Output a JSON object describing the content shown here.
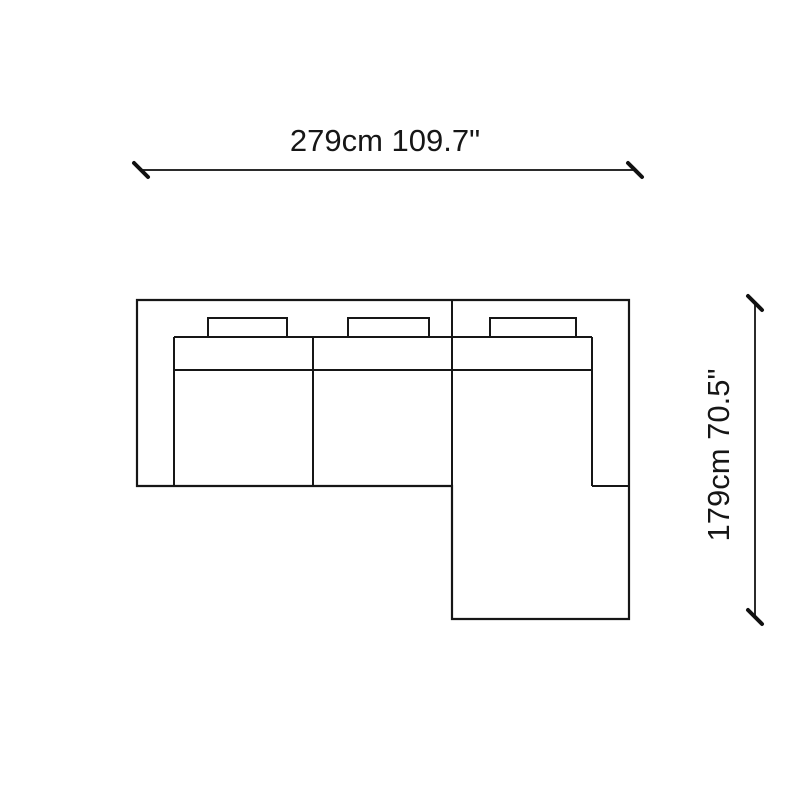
{
  "canvas": {
    "background": "#ffffff",
    "line_color": "#161616"
  },
  "dimensions": {
    "width": {
      "cm": "279cm",
      "inches": "109.7\"",
      "label": "279cm 109.7\""
    },
    "height": {
      "cm": "179cm",
      "inches": "70.5\"",
      "label": "179cm 70.5\""
    }
  },
  "sofa": {
    "type": "sectional-sofa-top-view",
    "back_cushion_count": 3,
    "seat_section_count": 2,
    "has_chaise": true
  }
}
